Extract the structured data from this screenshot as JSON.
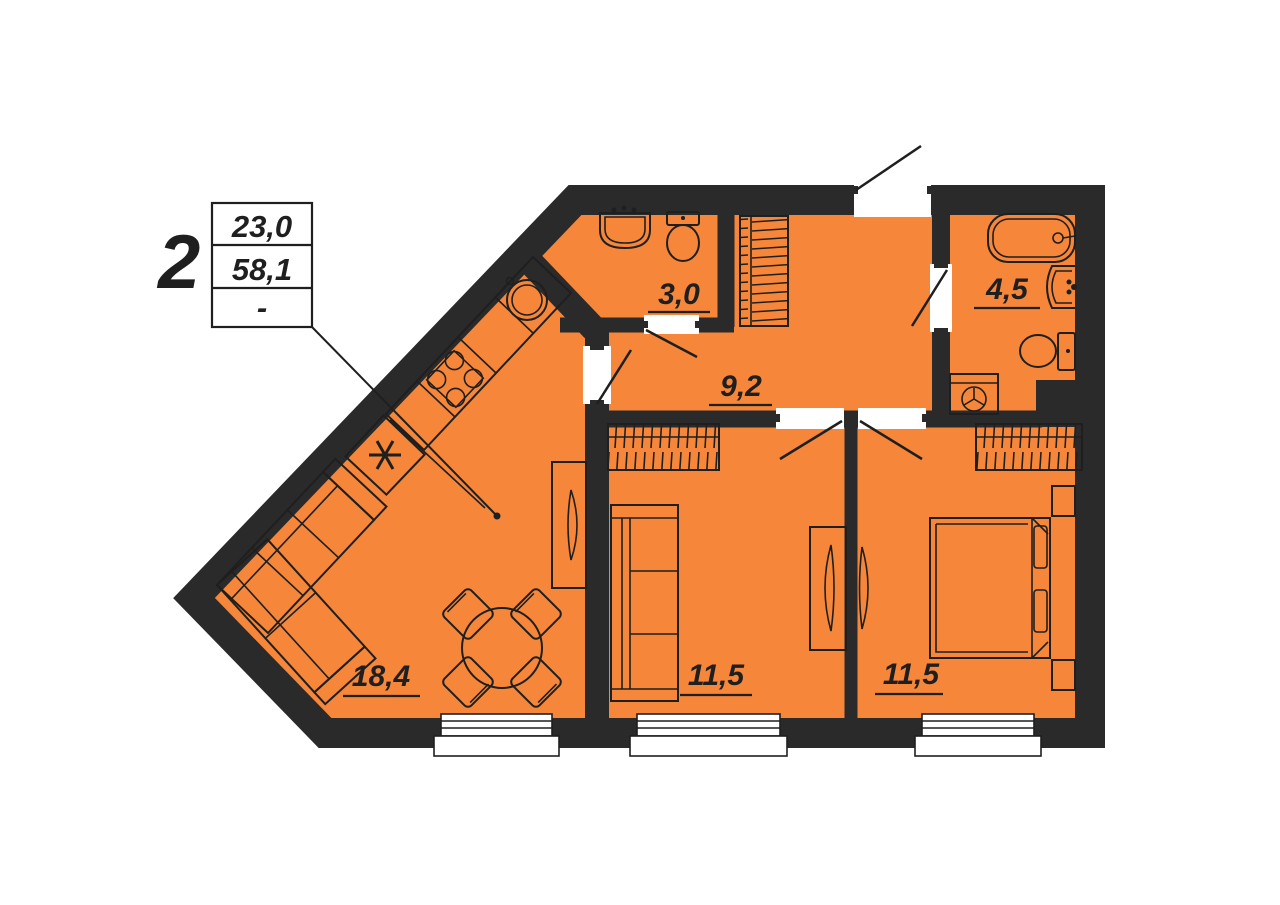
{
  "unit": {
    "rooms_count": "2",
    "info_table": {
      "row1": "23,0",
      "row2": "58,1",
      "row3": "-"
    }
  },
  "room_labels": {
    "wc": "3,0",
    "bathroom": "4,5",
    "hallway": "9,2",
    "living_kitchen": "18,4",
    "bedroom_1": "11,5",
    "bedroom_2": "11,5"
  },
  "icons": {
    "fridge_marker": "asterisk-snowflake",
    "kitchen_fixtures": [
      "round-sink",
      "stove-4-burners",
      "fridge"
    ],
    "wc_fixtures": [
      "wash-basin",
      "toilet"
    ],
    "bathroom_fixtures": [
      "bathtub",
      "wash-basin",
      "toilet",
      "washing-machine"
    ],
    "furniture": [
      "corner-sofa",
      "round-dining-table",
      "chairs",
      "tv-stand",
      "sofa",
      "double-bed",
      "nightstands",
      "wardrobes"
    ]
  },
  "colors": {
    "floor_fill": "#F5863A",
    "wall_fill": "#2A2A2A",
    "line_color": "#1F1F1F",
    "paper": "#FFFFFF"
  }
}
